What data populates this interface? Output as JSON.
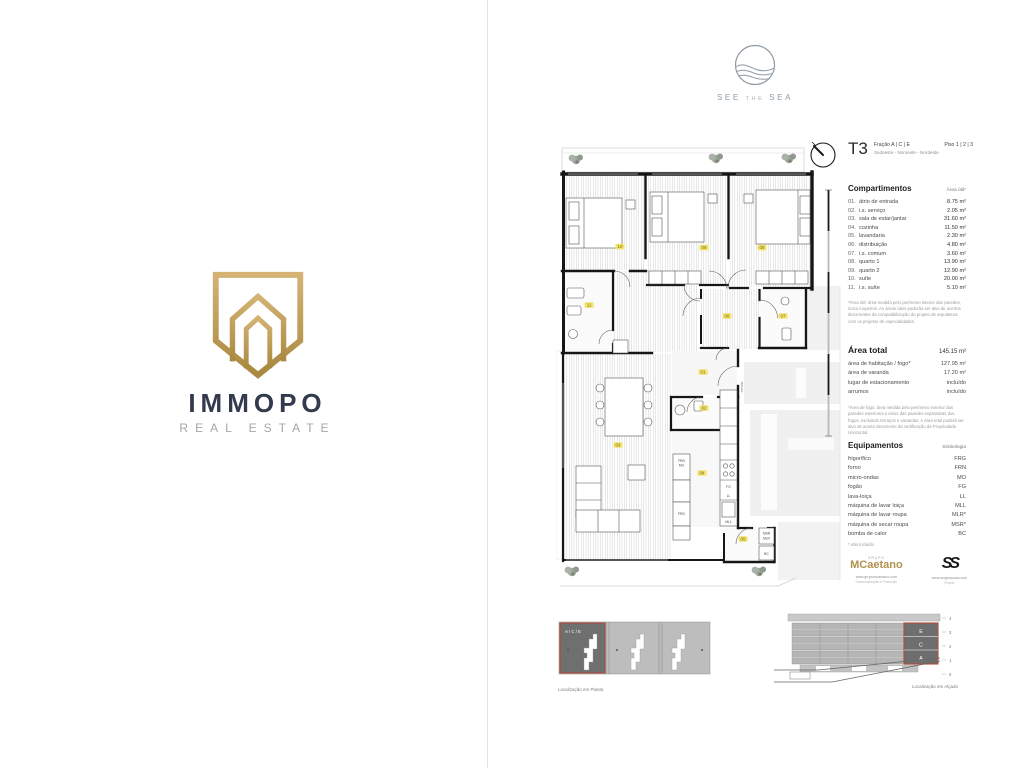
{
  "branding": {
    "immopo": {
      "name": "IMMOPO",
      "tagline": "REAL ESTATE"
    },
    "see_the_sea": {
      "word1": "SEE",
      "word2": "THE",
      "word3": "SEA"
    }
  },
  "header": {
    "typology": "T3",
    "fraction": "Fração A | C | E",
    "floors": "Piso 1 | 2 | 3",
    "orientation": "Sudoeste - Noroeste - Nordeste"
  },
  "compartments": {
    "title": "Compartimentos",
    "area_header": "Área útil*",
    "items": [
      {
        "num": "01.",
        "name": "átrio de entrada",
        "area": "8.75 m²"
      },
      {
        "num": "02.",
        "name": "i.s. serviço",
        "area": "2.05 m²"
      },
      {
        "num": "03.",
        "name": "sala de estar/jantar",
        "area": "31.60 m²"
      },
      {
        "num": "04.",
        "name": "cozinha",
        "area": "11.50 m²"
      },
      {
        "num": "05.",
        "name": "lavandaria",
        "area": "2.30 m²"
      },
      {
        "num": "06.",
        "name": "distribuição",
        "area": "4.80 m²"
      },
      {
        "num": "07.",
        "name": "i.s. comum",
        "area": "3.60 m²"
      },
      {
        "num": "08.",
        "name": "quarto 1",
        "area": "13.90 m²"
      },
      {
        "num": "09.",
        "name": "quarto 2",
        "area": "12.90 m²"
      },
      {
        "num": "10.",
        "name": "suíte",
        "area": "20.00 m²"
      },
      {
        "num": "11.",
        "name": "i.s. suíte",
        "area": "5.10 m²"
      }
    ],
    "footnote": "*Área útil: área medida pelo perímetro interior das paredes, inclui roupeiros. As áreas úteis poderão ser alvo de acertos decorrentes da compatibilização do projeto de arquitetura com os projetos de especialidades."
  },
  "totals": {
    "title": "Área total",
    "total": "145.15 m²",
    "rows": [
      {
        "label": "área de habitação / fogo*",
        "value": "127.95 m²"
      },
      {
        "label": "área de varanda",
        "value": "17.20 m²"
      },
      {
        "label": "lugar de estacionamento",
        "value": "incluído"
      },
      {
        "label": "arrumos",
        "value": "incluído"
      }
    ],
    "footnote": "*Área de fogo: área medida pelo perímetro exterior das paredes exteriores e eixos das paredes separativas dos fogos, excluindo terraços e varandas. A área total poderá ser alvo de acerto decorrente da certificação da Propriedade Horizontal."
  },
  "equipment": {
    "title": "Equipamentos",
    "symbol_header": "Simbologia",
    "items": [
      {
        "label": "frigorífico",
        "code": "FRG"
      },
      {
        "label": "forno",
        "code": "FRN"
      },
      {
        "label": "micro-ondas",
        "code": "MO"
      },
      {
        "label": "fogão",
        "code": "FG"
      },
      {
        "label": "lava-loiça",
        "code": "LL"
      },
      {
        "label": "máquina de lavar loiça",
        "code": "MLL"
      },
      {
        "label": "máquina de lavar roupa",
        "code": "MLR*"
      },
      {
        "label": "máquina de secar roupa",
        "code": "MSR*"
      },
      {
        "label": "bomba de calor",
        "code": "BC"
      }
    ],
    "note": "* não incluído"
  },
  "partners": {
    "mcaetano": {
      "group": "GRUPO",
      "name_initial": "M",
      "name_rest": "Caetano",
      "url": "www.grupomcaetano.com",
      "role": "Comercialização e Promoção"
    },
    "sergio": {
      "logo": "SS",
      "url": "www.sergiosousa.com",
      "role": "Projeto"
    }
  },
  "floorplan": {
    "rooms": {
      "suite": "10",
      "quarto2": "09",
      "quarto1": "08",
      "is_suite": "11",
      "distribuicao": "06",
      "is_comum": "07",
      "sala": "03",
      "atrio": "01",
      "is_servico": "02",
      "cozinha": "04",
      "lavandaria": "05"
    },
    "tags": {
      "frn": "FRN",
      "mo": "MO",
      "frg": "FRG",
      "fg": "FG",
      "ll": "LL",
      "mll": "MLL",
      "msr": "MSR",
      "mlr": "MLR",
      "bc": "BC",
      "entrada": "entrada"
    }
  },
  "locations": {
    "plan": {
      "caption": "Localização em Planta",
      "unit": "A / C / E"
    },
    "elevation": {
      "caption": "Localização em Alçado",
      "floors": [
        "4",
        "3",
        "2",
        "1",
        "0"
      ],
      "units": [
        "E",
        "C",
        "A"
      ]
    }
  }
}
